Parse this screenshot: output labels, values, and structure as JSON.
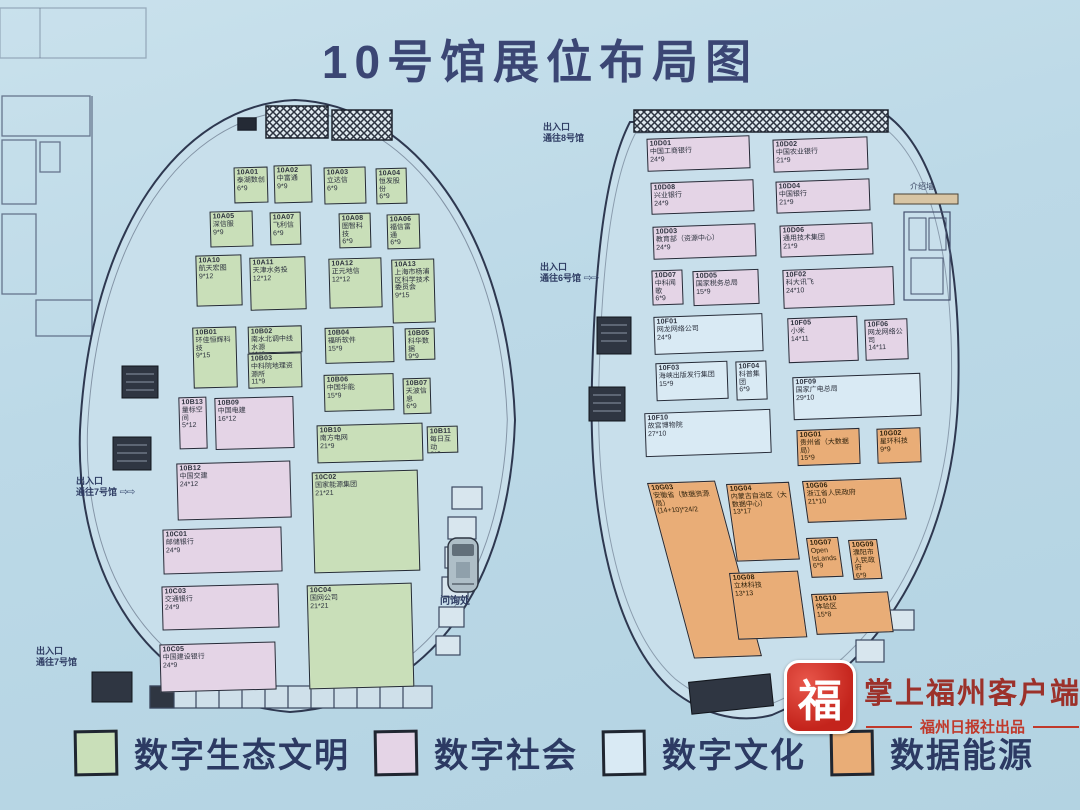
{
  "title": "10号馆展位布局图",
  "legend": [
    {
      "label": "数字生态文明",
      "cat": "eco",
      "color": "#c9dfb9"
    },
    {
      "label": "数字社会",
      "cat": "society",
      "color": "#e4d4e6"
    },
    {
      "label": "数字文化",
      "cat": "culture",
      "color": "#d9eaf4"
    },
    {
      "label": "数据能源",
      "cat": "energy",
      "color": "#e9ad77"
    }
  ],
  "halls": {
    "left": {
      "booths": [
        {
          "id": "10A01",
          "name": "泰湖数创",
          "size": "6*9",
          "cat": "eco",
          "x": 234,
          "y": 167,
          "w": 34,
          "h": 36
        },
        {
          "id": "10A02",
          "name": "中富通",
          "size": "9*9",
          "cat": "eco",
          "x": 274,
          "y": 165,
          "w": 38,
          "h": 38
        },
        {
          "id": "10A03",
          "name": "立达信",
          "size": "6*9",
          "cat": "eco",
          "x": 324,
          "y": 167,
          "w": 42,
          "h": 37
        },
        {
          "id": "10A04",
          "name": "恒发股份",
          "size": "6*9",
          "cat": "eco",
          "x": 376,
          "y": 168,
          "w": 31,
          "h": 36
        },
        {
          "id": "10A05",
          "name": "深信服",
          "size": "9*9",
          "cat": "eco",
          "x": 210,
          "y": 211,
          "w": 43,
          "h": 36
        },
        {
          "id": "10A07",
          "name": "飞利信",
          "size": "6*9",
          "cat": "eco",
          "x": 270,
          "y": 212,
          "w": 31,
          "h": 33
        },
        {
          "id": "10A08",
          "name": "图智科技",
          "size": "6*9",
          "cat": "eco",
          "x": 339,
          "y": 213,
          "w": 32,
          "h": 35
        },
        {
          "id": "10A06",
          "name": "福信富通",
          "size": "6*9",
          "cat": "eco",
          "x": 387,
          "y": 214,
          "w": 33,
          "h": 35
        },
        {
          "id": "10A10",
          "name": "航天宏图",
          "size": "9*12",
          "cat": "eco",
          "x": 196,
          "y": 255,
          "w": 46,
          "h": 51
        },
        {
          "id": "10A11",
          "name": "天津水务投",
          "size": "12*12",
          "cat": "eco",
          "x": 250,
          "y": 257,
          "w": 56,
          "h": 53
        },
        {
          "id": "10A12",
          "name": "正元地信",
          "size": "12*12",
          "cat": "eco",
          "x": 329,
          "y": 258,
          "w": 53,
          "h": 50
        },
        {
          "id": "10A13",
          "name": "上海市杨浦区科学技术委员会",
          "size": "9*15",
          "cat": "eco",
          "x": 392,
          "y": 259,
          "w": 43,
          "h": 64
        },
        {
          "id": "10B01",
          "name": "环佳恒辉科技",
          "size": "9*15",
          "cat": "eco",
          "x": 193,
          "y": 327,
          "w": 44,
          "h": 61
        },
        {
          "id": "10B02",
          "name": "南水北调中线水源",
          "size": "11*6",
          "cat": "eco",
          "x": 248,
          "y": 326,
          "w": 54,
          "h": 27
        },
        {
          "id": "10B03",
          "name": "中科院地理资源所",
          "size": "11*9",
          "cat": "eco",
          "x": 248,
          "y": 353,
          "w": 54,
          "h": 35
        },
        {
          "id": "10B04",
          "name": "福昕软件",
          "size": "15*9",
          "cat": "eco",
          "x": 325,
          "y": 327,
          "w": 69,
          "h": 36
        },
        {
          "id": "10B05",
          "name": "科华数据",
          "size": "9*9",
          "cat": "eco",
          "x": 405,
          "y": 328,
          "w": 30,
          "h": 32
        },
        {
          "id": "10B06",
          "name": "中国华能",
          "size": "15*9",
          "cat": "eco",
          "x": 324,
          "y": 374,
          "w": 70,
          "h": 37
        },
        {
          "id": "10B07",
          "name": "天波信息",
          "size": "6*9",
          "cat": "eco",
          "x": 403,
          "y": 378,
          "w": 28,
          "h": 36
        },
        {
          "id": "10B13",
          "name": "量标空间",
          "size": "5*12",
          "cat": "society",
          "x": 179,
          "y": 397,
          "w": 28,
          "h": 52
        },
        {
          "id": "10B09",
          "name": "中国电建",
          "size": "16*12",
          "cat": "society",
          "x": 215,
          "y": 397,
          "w": 79,
          "h": 52
        },
        {
          "id": "10B10",
          "name": "南方电网",
          "size": "21*9",
          "cat": "eco",
          "x": 317,
          "y": 424,
          "w": 106,
          "h": 38
        },
        {
          "id": "10B11",
          "name": "每日互动",
          "size": "6*6",
          "cat": "eco",
          "x": 427,
          "y": 426,
          "w": 31,
          "h": 27
        },
        {
          "id": "10B12",
          "name": "中国交建",
          "size": "24*12",
          "cat": "society",
          "x": 177,
          "y": 462,
          "w": 114,
          "h": 57
        },
        {
          "id": "10C02",
          "name": "国家能源集团",
          "size": "21*21",
          "cat": "eco",
          "x": 313,
          "y": 471,
          "w": 106,
          "h": 101
        },
        {
          "id": "10C01",
          "name": "邮储银行",
          "size": "24*9",
          "cat": "society",
          "x": 163,
          "y": 528,
          "w": 119,
          "h": 45
        },
        {
          "id": "10C03",
          "name": "交通银行",
          "size": "24*9",
          "cat": "society",
          "x": 162,
          "y": 585,
          "w": 117,
          "h": 44
        },
        {
          "id": "10C04",
          "name": "国网公司",
          "size": "21*21",
          "cat": "eco",
          "x": 308,
          "y": 584,
          "w": 105,
          "h": 104
        },
        {
          "id": "10C05",
          "name": "中国建设银行",
          "size": "24*9",
          "cat": "society",
          "x": 160,
          "y": 643,
          "w": 116,
          "h": 48
        }
      ]
    },
    "right": {
      "booths": [
        {
          "id": "10D01",
          "name": "中国工商银行",
          "size": "24*9",
          "cat": "society",
          "x": 647,
          "y": 137,
          "w": 103,
          "h": 33
        },
        {
          "id": "10D02",
          "name": "中国农业银行",
          "size": "21*9",
          "cat": "society",
          "x": 773,
          "y": 138,
          "w": 95,
          "h": 33
        },
        {
          "id": "10D08",
          "name": "兴业银行",
          "size": "24*9",
          "cat": "society",
          "x": 651,
          "y": 181,
          "w": 103,
          "h": 32
        },
        {
          "id": "10D04",
          "name": "中国银行",
          "size": "21*9",
          "cat": "society",
          "x": 776,
          "y": 180,
          "w": 94,
          "h": 32
        },
        {
          "id": "10D03",
          "name": "教育部（资源中心）",
          "size": "24*9",
          "cat": "society",
          "x": 653,
          "y": 225,
          "w": 103,
          "h": 33
        },
        {
          "id": "10D06",
          "name": "通用技术集团",
          "size": "21*9",
          "cat": "society",
          "x": 780,
          "y": 224,
          "w": 93,
          "h": 32
        },
        {
          "id": "10D07",
          "name": "中科闻歌",
          "size": "6*9",
          "cat": "society",
          "x": 652,
          "y": 270,
          "w": 31,
          "h": 35
        },
        {
          "id": "10D05",
          "name": "国家税务总局",
          "size": "15*9",
          "cat": "society",
          "x": 693,
          "y": 270,
          "w": 66,
          "h": 35
        },
        {
          "id": "10F02",
          "name": "科大讯飞",
          "size": "24*10",
          "cat": "society",
          "x": 783,
          "y": 268,
          "w": 111,
          "h": 39
        },
        {
          "id": "10F01",
          "name": "网龙网络公司",
          "size": "24*9",
          "cat": "culture",
          "x": 654,
          "y": 315,
          "w": 109,
          "h": 38
        },
        {
          "id": "10F05",
          "name": "小米",
          "size": "14*11",
          "cat": "society",
          "x": 788,
          "y": 317,
          "w": 70,
          "h": 45
        },
        {
          "id": "10F06",
          "name": "网龙网络公司",
          "size": "14*11",
          "cat": "society",
          "x": 865,
          "y": 319,
          "w": 43,
          "h": 41
        },
        {
          "id": "10F03",
          "name": "海峡出版发行集团",
          "size": "15*9",
          "cat": "culture",
          "x": 656,
          "y": 362,
          "w": 72,
          "h": 38
        },
        {
          "id": "10F04",
          "name": "科普集团",
          "size": "6*9",
          "cat": "culture",
          "x": 736,
          "y": 361,
          "w": 31,
          "h": 39
        },
        {
          "id": "10F09",
          "name": "国家广电总局",
          "size": "29*10",
          "cat": "culture",
          "x": 793,
          "y": 375,
          "w": 128,
          "h": 43
        },
        {
          "id": "10F10",
          "name": "故宫博物院",
          "size": "27*10",
          "cat": "culture",
          "x": 645,
          "y": 411,
          "w": 126,
          "h": 44
        },
        {
          "id": "10G01",
          "name": "贵州省（大数据局）",
          "size": "15*9",
          "cat": "energy",
          "x": 797,
          "y": 429,
          "w": 63,
          "h": 36
        },
        {
          "id": "10G02",
          "name": "星环科技",
          "size": "9*9",
          "cat": "energy",
          "x": 877,
          "y": 428,
          "w": 44,
          "h": 35
        },
        {
          "id": "10G03",
          "name": "安徽省（数据资源局）",
          "size": "(14+10)*24/2",
          "cat": "energy",
          "x": 647,
          "y": 483,
          "w": 68,
          "h": 177,
          "tf": "rotate(-2deg) skewX(13deg)"
        },
        {
          "id": "10G04",
          "name": "内蒙古自治区（大数据中心）",
          "size": "13*17",
          "cat": "energy",
          "x": 726,
          "y": 484,
          "w": 63,
          "h": 78,
          "tf": "rotate(-2deg) skewX(6deg)"
        },
        {
          "id": "10G06",
          "name": "浙江省人民政府",
          "size": "21*10",
          "cat": "energy",
          "x": 802,
          "y": 481,
          "w": 99,
          "h": 42,
          "tf": "rotate(-2deg) skewX(6deg)"
        },
        {
          "id": "10G07",
          "name": "Open IsLands",
          "size": "6*9",
          "cat": "energy",
          "x": 806,
          "y": 538,
          "w": 32,
          "h": 40,
          "tf": "rotate(-2deg) skewX(6deg)"
        },
        {
          "id": "10G09",
          "name": "濮阳市人民政府",
          "size": "6*9",
          "cat": "energy",
          "x": 848,
          "y": 540,
          "w": 29,
          "h": 40,
          "tf": "rotate(-2deg) skewX(6deg)"
        },
        {
          "id": "10G08",
          "name": "立林科技",
          "size": "13*13",
          "cat": "energy",
          "x": 729,
          "y": 573,
          "w": 69,
          "h": 67,
          "tf": "rotate(-2deg) skewX(6deg)"
        },
        {
          "id": "10G10",
          "name": "体验区",
          "size": "15*8",
          "cat": "energy",
          "x": 811,
          "y": 594,
          "w": 77,
          "h": 41,
          "tf": "rotate(-2deg) skewX(6deg)"
        }
      ]
    }
  },
  "annotations": {
    "entrances": [
      {
        "line1": "出入口",
        "line2": "通往8号馆",
        "x": 543,
        "y": 122,
        "arrow": false
      },
      {
        "line1": "出入口",
        "line2": "通往6号馆",
        "x": 540,
        "y": 262,
        "arrow": true
      },
      {
        "line1": "出入口",
        "line2": "通往7号馆",
        "x": 76,
        "y": 476,
        "arrow": true
      },
      {
        "line1": "出入口",
        "line2": "通往7号馆",
        "x": 36,
        "y": 646,
        "arrow": false
      }
    ],
    "info_wall": "介绍墙",
    "inquiry": "问询处"
  },
  "watermark": {
    "logo_glyph": "福",
    "line1": "掌上福州客户端",
    "line2": "福州日报社出品"
  }
}
